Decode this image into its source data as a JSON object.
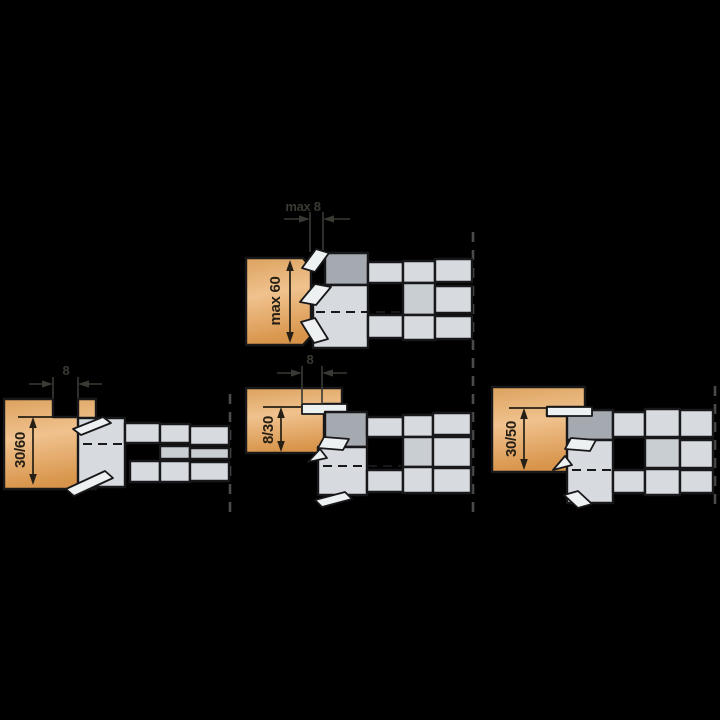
{
  "page": {
    "background": "#000000"
  },
  "colors": {
    "wood_top": "#dca25e",
    "wood_mid": "#f0c28e",
    "wood_bottom": "#d8944a",
    "steel": "#d7dbdf",
    "steel_alt": "#c9ced3",
    "clamp": "#a4aab0",
    "knife": "#eef1f2",
    "outline": "#18181a",
    "dash_line": "#4b4b4b",
    "dim": "#3a3a34",
    "dim_wood": "#251f15"
  },
  "diagrams": {
    "top": {
      "width_label": "max 8",
      "depth_label": "max 60"
    },
    "bottom_left": {
      "width_label": "8",
      "depth_label": "30/60"
    },
    "bottom_middle": {
      "width_label": "8",
      "depth_label": "8/30"
    },
    "bottom_right": {
      "depth_label": "30/50"
    }
  }
}
